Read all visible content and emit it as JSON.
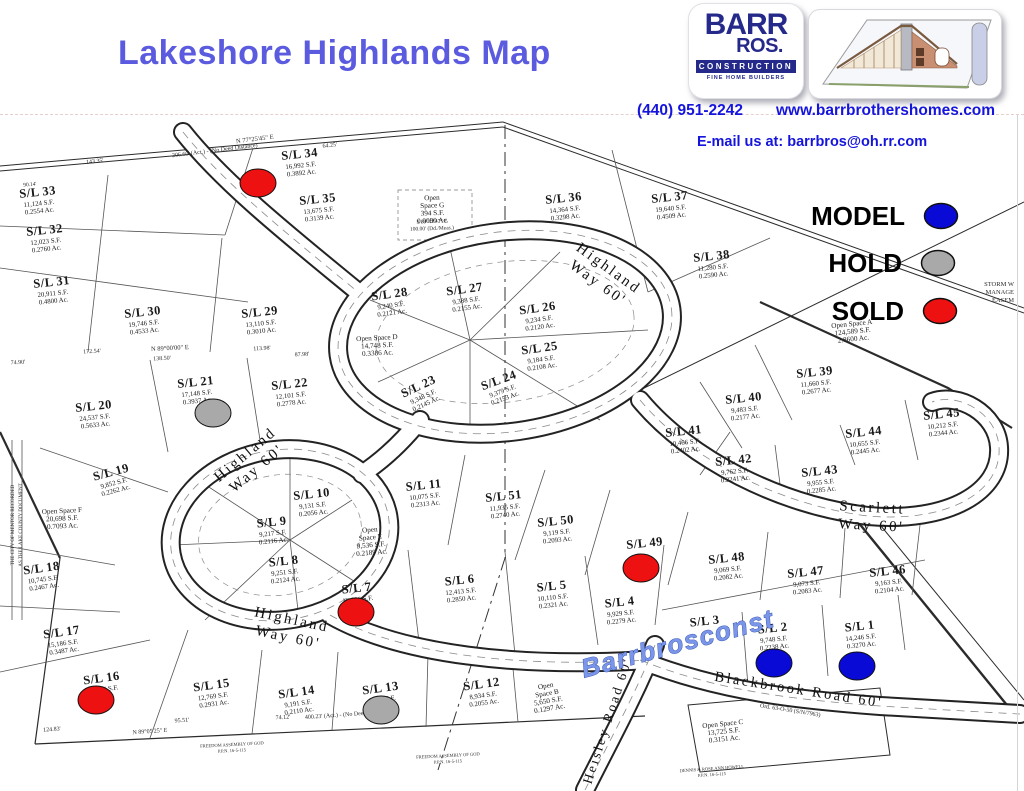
{
  "header": {
    "title": "Lakeshore Highlands Map",
    "phone": "(440) 951-2242",
    "website": "www.barrbrothershomes.com",
    "email_line": "E-mail us at: barrbros@oh.rr.com",
    "logo": {
      "line1": "BARR",
      "line2": "ROS.",
      "bar": "CONSTRUCTION",
      "tagline": "FINE HOME BUILDERS",
      "house_logo": "house-blueprint-illustration"
    }
  },
  "colors": {
    "title_blue": "#5b5bdf",
    "contact_blue": "#1414dd",
    "logo_navy": "#252a8a",
    "model": "#0a0ad6",
    "hold": "#a9a9a9",
    "sold": "#ee1111",
    "map_ink": "#222222"
  },
  "legend": {
    "items": [
      {
        "label": "MODEL",
        "status": "model",
        "color": "#0a0ad6",
        "x": 941,
        "y": 216
      },
      {
        "label": "HOLD",
        "status": "hold",
        "color": "#a9a9a9",
        "x": 938,
        "y": 263
      },
      {
        "label": "SOLD",
        "status": "sold",
        "color": "#ee1111",
        "x": 940,
        "y": 311
      }
    ]
  },
  "map": {
    "watermark": {
      "text": "Barrbrosconst",
      "x": 680,
      "y": 652,
      "rot": -15
    },
    "road_labels": [
      {
        "lines": [
          "Highland",
          "Way 60'"
        ],
        "x": 606,
        "y": 272,
        "rot": 36,
        "size": 15
      },
      {
        "lines": [
          "Highland",
          "Way 60'"
        ],
        "x": 248,
        "y": 458,
        "rot": -40,
        "size": 15
      },
      {
        "lines": [
          "Highland",
          "Way 60'"
        ],
        "x": 291,
        "y": 624,
        "rot": 12,
        "size": 15
      },
      {
        "lines": [
          "Scarlett",
          "Way 60'"
        ],
        "x": 872,
        "y": 512,
        "rot": 3,
        "size": 15
      },
      {
        "lines": [
          "Blackbrook Road 60'"
        ],
        "x": 798,
        "y": 694,
        "rot": 9,
        "size": 14.5
      },
      {
        "lines": [
          "West Heisley Road 60'"
        ],
        "x": 605,
        "y": 742,
        "rot": -72,
        "size": 13.5
      }
    ],
    "lots": [
      {
        "n": "S/L 1",
        "s": "14,246 S.F.",
        "a": "0.3270 Ac.",
        "x": 860,
        "y": 630,
        "r": -6
      },
      {
        "n": "S/L 2",
        "s": "9,748 S.F.",
        "a": "0.2238 Ac.",
        "x": 773,
        "y": 632,
        "r": -6
      },
      {
        "n": "S/L 3",
        "s": "",
        "a": "",
        "x": 705,
        "y": 625,
        "r": -6
      },
      {
        "n": "S/L 4",
        "s": "9,929 S.F.",
        "a": "0.2279 Ac.",
        "x": 620,
        "y": 606,
        "r": -6
      },
      {
        "n": "S/L 5",
        "s": "10,110 S.F.",
        "a": "0.2321 Ac.",
        "x": 552,
        "y": 590,
        "r": -6
      },
      {
        "n": "S/L 6",
        "s": "12,413 S.F.",
        "a": "0.2850 Ac.",
        "x": 460,
        "y": 584,
        "r": -6
      },
      {
        "n": "S/L 7",
        "s": "10,626 S.F.",
        "a": "",
        "x": 357,
        "y": 592,
        "r": -6
      },
      {
        "n": "S/L 8",
        "s": "9,251 S.F.",
        "a": "0.2124 Ac.",
        "x": 284,
        "y": 565,
        "r": -6
      },
      {
        "n": "S/L 9",
        "s": "9,217 S.F.",
        "a": "0.2116 Ac.",
        "x": 272,
        "y": 526,
        "r": -6
      },
      {
        "n": "S/L 10",
        "s": "9,131 S.F.",
        "a": "0.2056 Ac.",
        "x": 312,
        "y": 498,
        "r": -6
      },
      {
        "n": "S/L 11",
        "s": "10,075 S.F.",
        "a": "0.2313 Ac.",
        "x": 424,
        "y": 489,
        "r": -6
      },
      {
        "n": "S/L 12",
        "s": "8,934 S.F.",
        "a": "0.2055 Ac.",
        "x": 482,
        "y": 688,
        "r": -8
      },
      {
        "n": "S/L 13",
        "s": "8,294 S.F.",
        "a": "",
        "x": 381,
        "y": 692,
        "r": -8
      },
      {
        "n": "S/L 14",
        "s": "9,191 S.F.",
        "a": "0.2110 Ac.",
        "x": 297,
        "y": 696,
        "r": -8
      },
      {
        "n": "S/L 15",
        "s": "12,769 S.F.",
        "a": "0.2931 Ac.",
        "x": 212,
        "y": 689,
        "r": -8
      },
      {
        "n": "S/L 16",
        "s": "21,344 S.F.",
        "a": "",
        "x": 102,
        "y": 682,
        "r": -8
      },
      {
        "n": "S/L 17",
        "s": "15,186 S.F.",
        "a": "0.3487 Ac.",
        "x": 62,
        "y": 636,
        "r": -8
      },
      {
        "n": "S/L 18",
        "s": "10,745 S.F.",
        "a": "0.2467 Ac.",
        "x": 42,
        "y": 572,
        "r": -8
      },
      {
        "n": "S/L 19",
        "s": "9,852 S.F.",
        "a": "0.2262 Ac.",
        "x": 112,
        "y": 476,
        "r": -15
      },
      {
        "n": "S/L 20",
        "s": "24,537 S.F.",
        "a": "0.5633 Ac.",
        "x": 94,
        "y": 410,
        "r": -6
      },
      {
        "n": "S/L 21",
        "s": "17,148 S.F.",
        "a": "0.3937 Ac.",
        "x": 196,
        "y": 386,
        "r": -6
      },
      {
        "n": "S/L 22",
        "s": "12,101 S.F.",
        "a": "0.2778 Ac.",
        "x": 290,
        "y": 388,
        "r": -6
      },
      {
        "n": "S/L 23",
        "s": "9,348 S.F.",
        "a": "0.2145 Ac.",
        "x": 420,
        "y": 390,
        "r": -25
      },
      {
        "n": "S/L 24",
        "s": "9,379 S.F.",
        "a": "0.2153 Ac.",
        "x": 500,
        "y": 384,
        "r": -20
      },
      {
        "n": "S/L 25",
        "s": "9,184 S.F.",
        "a": "0.2108 Ac.",
        "x": 540,
        "y": 352,
        "r": -8
      },
      {
        "n": "S/L 26",
        "s": "9,234 S.F.",
        "a": "0.2120 Ac.",
        "x": 538,
        "y": 312,
        "r": -8
      },
      {
        "n": "S/L 27",
        "s": "9,388 S.F.",
        "a": "0.2155 Ac.",
        "x": 465,
        "y": 293,
        "r": -8
      },
      {
        "n": "S/L 28",
        "s": "9,240 S.F.",
        "a": "0.2121 Ac.",
        "x": 390,
        "y": 298,
        "r": -8
      },
      {
        "n": "S/L 29",
        "s": "13,110 S.F.",
        "a": "0.3010 Ac.",
        "x": 260,
        "y": 316,
        "r": -6
      },
      {
        "n": "S/L 30",
        "s": "19,746 S.F.",
        "a": "0.4533 Ac.",
        "x": 143,
        "y": 316,
        "r": -6
      },
      {
        "n": "S/L 31",
        "s": "20,911 S.F.",
        "a": "0.4800 Ac.",
        "x": 52,
        "y": 286,
        "r": -6
      },
      {
        "n": "S/L 32",
        "s": "12,023 S.F.",
        "a": "0.2760 Ac.",
        "x": 45,
        "y": 234,
        "r": -6
      },
      {
        "n": "S/L 33",
        "s": "11,124 S.F.",
        "a": "0.2554 Ac.",
        "x": 38,
        "y": 196,
        "r": -6
      },
      {
        "n": "S/L 34",
        "s": "16,992 S.F.",
        "a": "0.3892 Ac.",
        "x": 300,
        "y": 158,
        "r": -6
      },
      {
        "n": "S/L 35",
        "s": "13,675 S.F.",
        "a": "0.3139 Ac.",
        "x": 318,
        "y": 203,
        "r": -6
      },
      {
        "n": "S/L 36",
        "s": "14,364 S.F.",
        "a": "0.3298 Ac.",
        "x": 564,
        "y": 202,
        "r": -6
      },
      {
        "n": "S/L 37",
        "s": "19,640 S.F.",
        "a": "0.4509 Ac.",
        "x": 670,
        "y": 201,
        "r": -6
      },
      {
        "n": "S/L 38",
        "s": "11,280 S.F.",
        "a": "0.2590 Ac.",
        "x": 712,
        "y": 260,
        "r": -6
      },
      {
        "n": "S/L 39",
        "s": "11,660 S.F.",
        "a": "0.2677 Ac.",
        "x": 815,
        "y": 376,
        "r": -6
      },
      {
        "n": "S/L 40",
        "s": "9,483 S.F.",
        "a": "0.2177 Ac.",
        "x": 744,
        "y": 402,
        "r": -6
      },
      {
        "n": "S/L 41",
        "s": "10,466 S.F.",
        "a": "0.2402 Ac.",
        "x": 684,
        "y": 435,
        "r": -6
      },
      {
        "n": "S/L 42",
        "s": "9,762 S.F.",
        "a": "0.2241 Ac.",
        "x": 734,
        "y": 464,
        "r": -6
      },
      {
        "n": "S/L 43",
        "s": "9,955 S.F.",
        "a": "0.2285 Ac.",
        "x": 820,
        "y": 475,
        "r": -6
      },
      {
        "n": "S/L 44",
        "s": "10,655 S.F.",
        "a": "0.2445 Ac.",
        "x": 864,
        "y": 436,
        "r": -6
      },
      {
        "n": "S/L 45",
        "s": "10,212 S.F.",
        "a": "0.2344 Ac.",
        "x": 942,
        "y": 418,
        "r": -6
      },
      {
        "n": "S/L 46",
        "s": "9,163 S.F.",
        "a": "0.2104 Ac.",
        "x": 888,
        "y": 575,
        "r": -6
      },
      {
        "n": "S/L 47",
        "s": "9,073 S.F.",
        "a": "0.2083 Ac.",
        "x": 806,
        "y": 576,
        "r": -6
      },
      {
        "n": "S/L 48",
        "s": "9,069 S.F.",
        "a": "0.2082 Ac.",
        "x": 727,
        "y": 562,
        "r": -6
      },
      {
        "n": "S/L 49",
        "s": "",
        "a": "",
        "x": 645,
        "y": 547,
        "r": -6
      },
      {
        "n": "S/L 50",
        "s": "9,119 S.F.",
        "a": "0.2093 Ac.",
        "x": 556,
        "y": 525,
        "r": -6
      },
      {
        "n": "S/L 51",
        "s": "11,935 S.F.",
        "a": "0.2740 Ac.",
        "x": 504,
        "y": 500,
        "r": -6
      }
    ],
    "open_spaces": [
      {
        "lines": [
          "Open Space A",
          "124,589 S.F.",
          "2.8600 Ac."
        ],
        "x": 852,
        "y": 326,
        "r": -6
      },
      {
        "lines": [
          "Open",
          "Space B",
          "5,650 S.F.",
          "0.1297 Ac."
        ],
        "x": 546,
        "y": 688,
        "r": -10
      },
      {
        "lines": [
          "Open Space C",
          "13,725 S.F.",
          "0.3151 Ac."
        ],
        "x": 723,
        "y": 726,
        "r": -6
      },
      {
        "lines": [
          "Open Space D",
          "14,748 S.F.",
          "0.3386 Ac."
        ],
        "x": 377,
        "y": 340,
        "r": -3
      },
      {
        "lines": [
          "Open",
          "Space E",
          "9,536 S.F.",
          "0.2189 Ac."
        ],
        "x": 370,
        "y": 532,
        "r": -5
      },
      {
        "lines": [
          "Open Space F",
          "20,698 S.F.",
          "0.7093 Ac."
        ],
        "x": 62,
        "y": 513,
        "r": -3
      },
      {
        "lines": [
          "Open",
          "Space G",
          "394 S.F.",
          "0.0090 Ac."
        ],
        "x": 432,
        "y": 200,
        "r": -2
      }
    ],
    "markers": [
      {
        "lot": "S/L 34",
        "status": "sold",
        "x": 258,
        "y": 183
      },
      {
        "lot": "S/L 21",
        "status": "hold",
        "x": 213,
        "y": 413
      },
      {
        "lot": "S/L 7",
        "status": "sold",
        "x": 356,
        "y": 612
      },
      {
        "lot": "S/L 16",
        "status": "sold",
        "x": 96,
        "y": 700
      },
      {
        "lot": "S/L 13",
        "status": "hold",
        "x": 381,
        "y": 710
      },
      {
        "lot": "S/L 49",
        "status": "sold",
        "x": 641,
        "y": 568
      },
      {
        "lot": "S/L 2",
        "status": "model",
        "x": 774,
        "y": 663
      },
      {
        "lot": "S/L 1",
        "status": "model",
        "x": 857,
        "y": 666
      }
    ],
    "survey_texts": [
      {
        "t": "N 77°25'45\" E",
        "x": 255,
        "y": 141,
        "r": -7,
        "s": 6.5
      },
      {
        "t": "206.60' (Act.) - (No Deed Distance)",
        "x": 215,
        "y": 152,
        "r": -7,
        "s": 6
      },
      {
        "t": "143.35'",
        "x": 95,
        "y": 163,
        "r": -6,
        "s": 6
      },
      {
        "t": "64.25'",
        "x": 330,
        "y": 147,
        "r": -7,
        "s": 6
      },
      {
        "t": "90.14'",
        "x": 30,
        "y": 186,
        "r": -5,
        "s": 5.5
      },
      {
        "t": "172.54'",
        "x": 92,
        "y": 353,
        "r": -3,
        "s": 6
      },
      {
        "t": "N 89°00'00\" E",
        "x": 170,
        "y": 350,
        "r": -3,
        "s": 6.5
      },
      {
        "t": "138.50'",
        "x": 162,
        "y": 360,
        "r": -3,
        "s": 6
      },
      {
        "t": "113.98'",
        "x": 262,
        "y": 350,
        "r": -3,
        "s": 6
      },
      {
        "t": "87.98'",
        "x": 302,
        "y": 356,
        "r": -3,
        "s": 6
      },
      {
        "t": "74.90'",
        "x": 18,
        "y": 364,
        "r": -3,
        "s": 6
      },
      {
        "t": "124.83'",
        "x": 52,
        "y": 731,
        "r": -4,
        "s": 6
      },
      {
        "t": "95.51'",
        "x": 182,
        "y": 722,
        "r": -4,
        "s": 6
      },
      {
        "t": "N 89°05'25\" E",
        "x": 150,
        "y": 733,
        "r": -4,
        "s": 6
      },
      {
        "t": "74.12'",
        "x": 283,
        "y": 719,
        "r": -4,
        "s": 6
      },
      {
        "t": "400.23' (Act.) - (No Deed Distance)",
        "x": 348,
        "y": 716,
        "r": -4,
        "s": 6
      },
      {
        "t": "Ord. 63-O-50 (S/N/7963)",
        "x": 790,
        "y": 712,
        "r": 9,
        "s": 6
      },
      {
        "t": "S 89°42'47\" E",
        "x": 432,
        "y": 223,
        "r": -2,
        "s": 5.5
      },
      {
        "t": "100.00' (Dd./Meas.)",
        "x": 432,
        "y": 230,
        "r": -2,
        "s": 5.5
      },
      {
        "t": "STORM W",
        "x": 1014,
        "y": 286,
        "r": 0,
        "s": 6.5,
        "a": "end"
      },
      {
        "t": "MANAGE",
        "x": 1014,
        "y": 294,
        "r": 0,
        "s": 6.5,
        "a": "end"
      },
      {
        "t": "EASEM",
        "x": 1014,
        "y": 302,
        "r": 0,
        "s": 6.5,
        "a": "end"
      },
      {
        "t": "THE CITY OF MENTOR RECORDED",
        "x": 14,
        "y": 525,
        "r": -90,
        "s": 5
      },
      {
        "t": "AS THE LAKE COUNTY DOCUMENT",
        "x": 22,
        "y": 525,
        "r": -90,
        "s": 5
      },
      {
        "t": "FREEDOM ASSEMBLY OF GOD",
        "x": 232,
        "y": 746,
        "r": -3,
        "s": 4.5
      },
      {
        "t": "P.P.N. 16-5-115",
        "x": 232,
        "y": 752,
        "r": -3,
        "s": 4.5
      },
      {
        "t": "FREEDOM ASSEMBLY OF GOD",
        "x": 448,
        "y": 757,
        "r": -3,
        "s": 4.5
      },
      {
        "t": "P.P.N. 16-5-115",
        "x": 448,
        "y": 763,
        "r": -3,
        "s": 4.5
      },
      {
        "t": "DENNIS & ROSE ANN HOWELL",
        "x": 712,
        "y": 770,
        "r": -4,
        "s": 4.5
      },
      {
        "t": "P.P.N. 16-5-115",
        "x": 712,
        "y": 776,
        "r": -4,
        "s": 4.5
      }
    ]
  }
}
